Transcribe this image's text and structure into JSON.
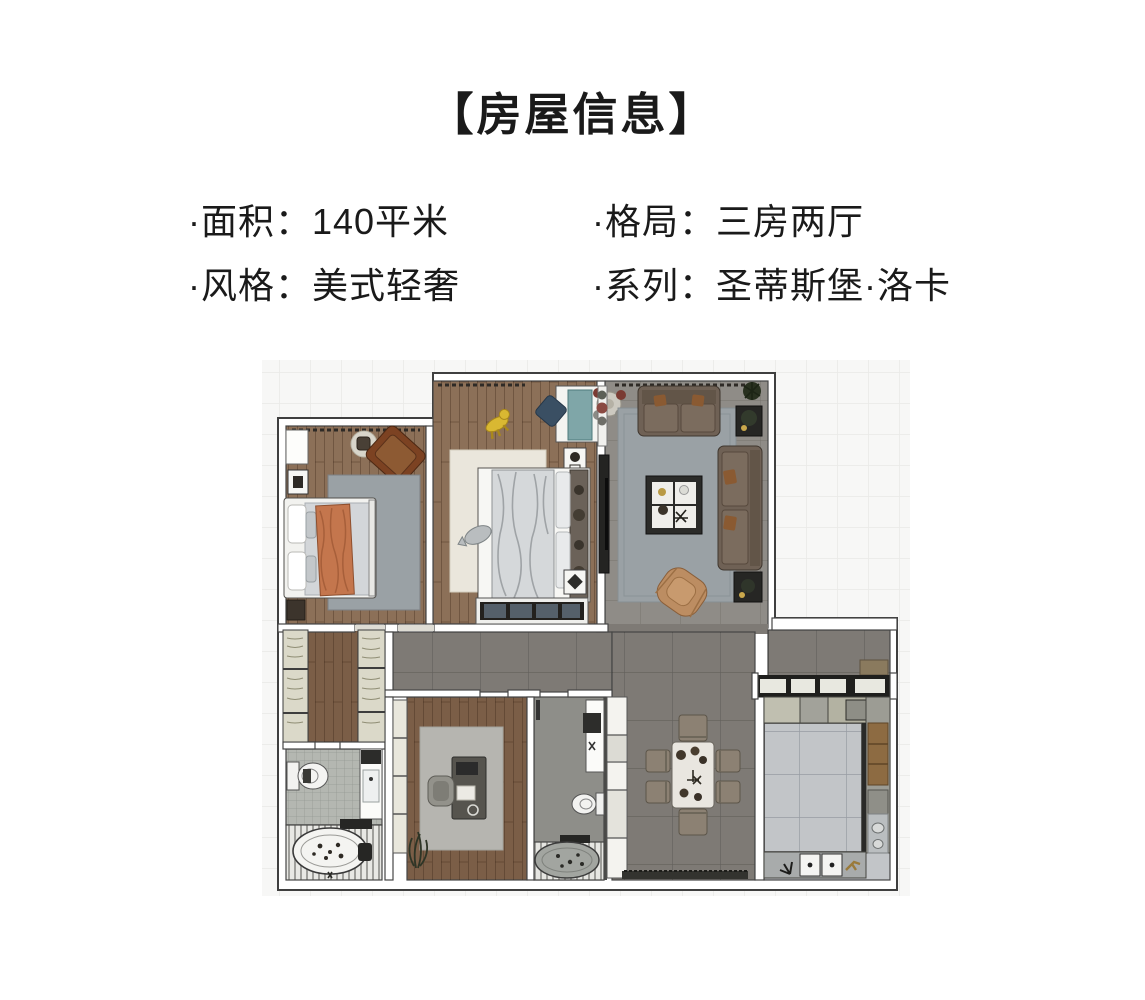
{
  "header": {
    "title": "【房屋信息】",
    "info": [
      {
        "label": "面积",
        "value": "140平米",
        "text": "·面积：140平米"
      },
      {
        "label": "格局",
        "value": "三房两厅",
        "text": "·格局：三房两厅"
      },
      {
        "label": "风格",
        "value": "美式轻奢",
        "text": "·风格：美式轻奢"
      },
      {
        "label": "系列",
        "value": "圣蒂斯堡·洛卡",
        "text": "·系列：圣蒂斯堡·洛卡"
      }
    ]
  },
  "palette": {
    "ink": "#1a1a1a",
    "wallFill": "#ffffff",
    "wallStroke": "#454545",
    "planBg": "#f7f7f6",
    "gridLine": "#e9e9e7",
    "wood": "#8c7058",
    "woodDark": "#7b5e47",
    "tile": "#8f8c87",
    "tileDark": "#7e7a75",
    "bathTile": "#b4b7b1",
    "kitchenFloor": "#c2c5c8",
    "rugGray": "#9aa1a5",
    "rugCream": "#eae6dc",
    "rugStudy": "#b6b5b0",
    "sofa": "#6f6155",
    "accentTan": "#bc8d62",
    "blanketOrange": "#c4764d",
    "cabinetCream": "#dbd9c9",
    "darkFixture": "#262624",
    "duvet": "#d5d8da",
    "counterGreen": "#b3b2a2",
    "boardBrown": "#8d6b42",
    "toyYellow": "#d9b832",
    "tealDesk": "#7fa6a8",
    "navyChair": "#3a4f63",
    "tubGray": "#a2a5a0",
    "chairTaupe": "#8c8173",
    "tableTop": "#e9e6e0"
  }
}
